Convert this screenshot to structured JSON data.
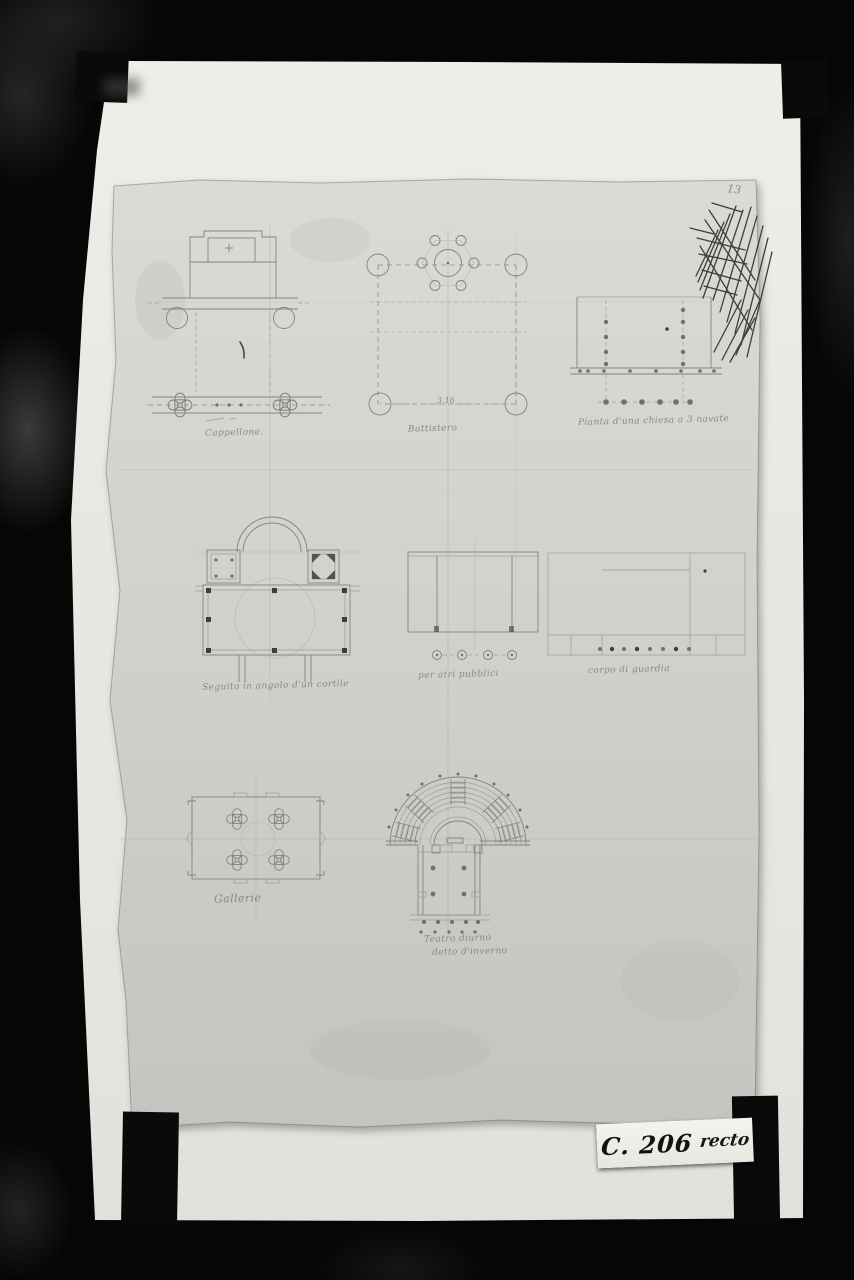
{
  "photo": {
    "description": "Black-and-white archival photograph of a sheet of architectural pencil sketches clamped over a white backing board",
    "background_color": "#060606",
    "backing_sheet_color": "#e9e8e2",
    "drawing_sheet_color": "#d5d4cf",
    "pencil_color": "#84837e",
    "ink_scribble_color": "#3d3d3c"
  },
  "archive_label": {
    "code": "C. 206",
    "side": "recto"
  },
  "sheet": {
    "folio_mark": "13",
    "plans": [
      {
        "id": "cappellone",
        "caption": "Cappellone."
      },
      {
        "id": "battistero",
        "caption": "Battistero",
        "measurement": "3.16"
      },
      {
        "id": "chiesa-tre-navate",
        "caption": "Pianta d'una chiesa a 3 navate"
      },
      {
        "id": "angolo-cortile",
        "caption": "Seguito in angolo d'un cortile"
      },
      {
        "id": "atri-pubblici",
        "caption": "per atri pubblici"
      },
      {
        "id": "corpo-di-guardia",
        "caption": "corpo di guardia"
      },
      {
        "id": "gallerie",
        "caption": "Gallerie"
      },
      {
        "id": "teatro",
        "caption": "Teatro diurno",
        "caption_line2": "detto d'inverno"
      }
    ]
  }
}
